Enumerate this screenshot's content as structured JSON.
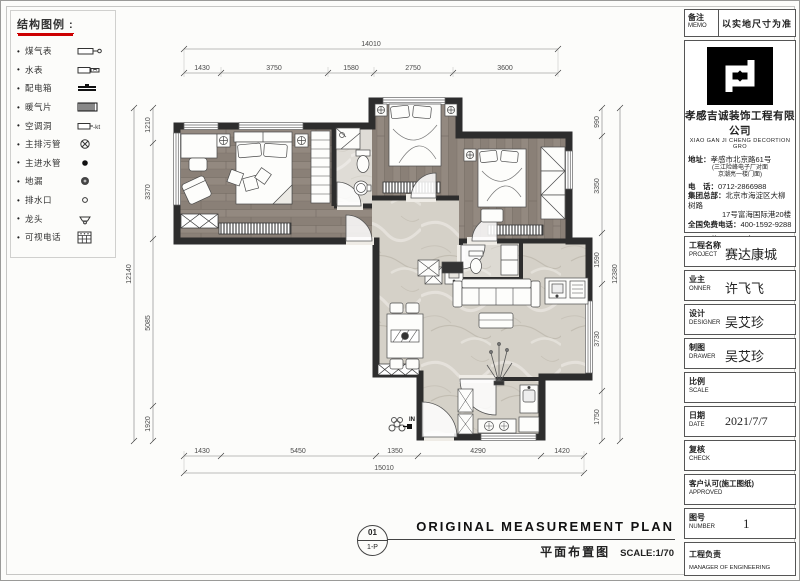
{
  "legend": {
    "title": "结构图例 :",
    "items": [
      {
        "label": "煤气表"
      },
      {
        "label": "水表"
      },
      {
        "label": "配电箱"
      },
      {
        "label": "暖气片"
      },
      {
        "label": "空调洞",
        "suffix": "-kt"
      },
      {
        "label": "主排污管"
      },
      {
        "label": "主进水管"
      },
      {
        "label": "地漏"
      },
      {
        "label": "排水口"
      },
      {
        "label": "龙头"
      },
      {
        "label": "可视电话"
      }
    ]
  },
  "memo": {
    "label_cn": "备注",
    "label_en": "MEMO",
    "text": "以实地尺寸为准"
  },
  "company": {
    "name_cn": "孝感吉诚装饰工程有限公司",
    "name_en": "XIAO GAN JI CHENG  DECORTION GRO",
    "address_label": "地址：",
    "address": "孝感市北京路61号",
    "address_note1": "(三江险峰电子厂对面",
    "address_note2": "京潮亮一楼门面)",
    "phone_label": "电　话：",
    "phone": "0712-2866988",
    "hq_label": "集团总部：",
    "hq_line1": "北京市海淀区大柳树路",
    "hq_line2": "17号富海国际港20楼",
    "hotline_label": "全国免费电话：",
    "hotline": "400-1592-9288",
    "website": "Http://www.xg.jc498.com"
  },
  "project": {
    "rows": [
      {
        "cn": "工程名称",
        "en": "PROJECT",
        "value": "赛达康城"
      },
      {
        "cn": "业主",
        "en": "ONNER",
        "value": "许飞飞"
      },
      {
        "cn": "设计",
        "en": "DESIGNER",
        "value": "吴艾珍"
      },
      {
        "cn": "制图",
        "en": "DRAWER",
        "value": "吴艾珍"
      },
      {
        "cn": "比例",
        "en": "SCALE",
        "value": ""
      },
      {
        "cn": "日期",
        "en": "DATE",
        "value": "2021/7/7"
      },
      {
        "cn": "复核",
        "en": "CHECK",
        "value": ""
      },
      {
        "cn": "客户认可(施工图纸)",
        "en": "APPROVED",
        "value": ""
      },
      {
        "cn": "图号",
        "en": "NUMBER",
        "value": "1"
      },
      {
        "cn": "工程负责",
        "en": "MANAGER OF ENGINEERING",
        "value": ""
      }
    ]
  },
  "title_block": {
    "circle_top": "01",
    "circle_bottom": "1-P",
    "title_en": "ORIGINAL MEASUREMENT PLAN",
    "title_cn": "平面布置图",
    "scale": "SCALE:1/70"
  },
  "dimensions": {
    "top_total": "14010",
    "top": [
      "1430",
      "3750",
      "1580",
      "2750",
      "3600"
    ],
    "left_total": "12140",
    "left": [
      "1210",
      "3370",
      "5085",
      "1920"
    ],
    "right_total": "12380",
    "right": [
      "990",
      "3350",
      "1590",
      "3730",
      "1750"
    ],
    "bottom": [
      "1430",
      "5450",
      "1350",
      "4290",
      "1420"
    ],
    "bottom_total": "15010"
  },
  "plan": {
    "entry_label": "IN"
  }
}
